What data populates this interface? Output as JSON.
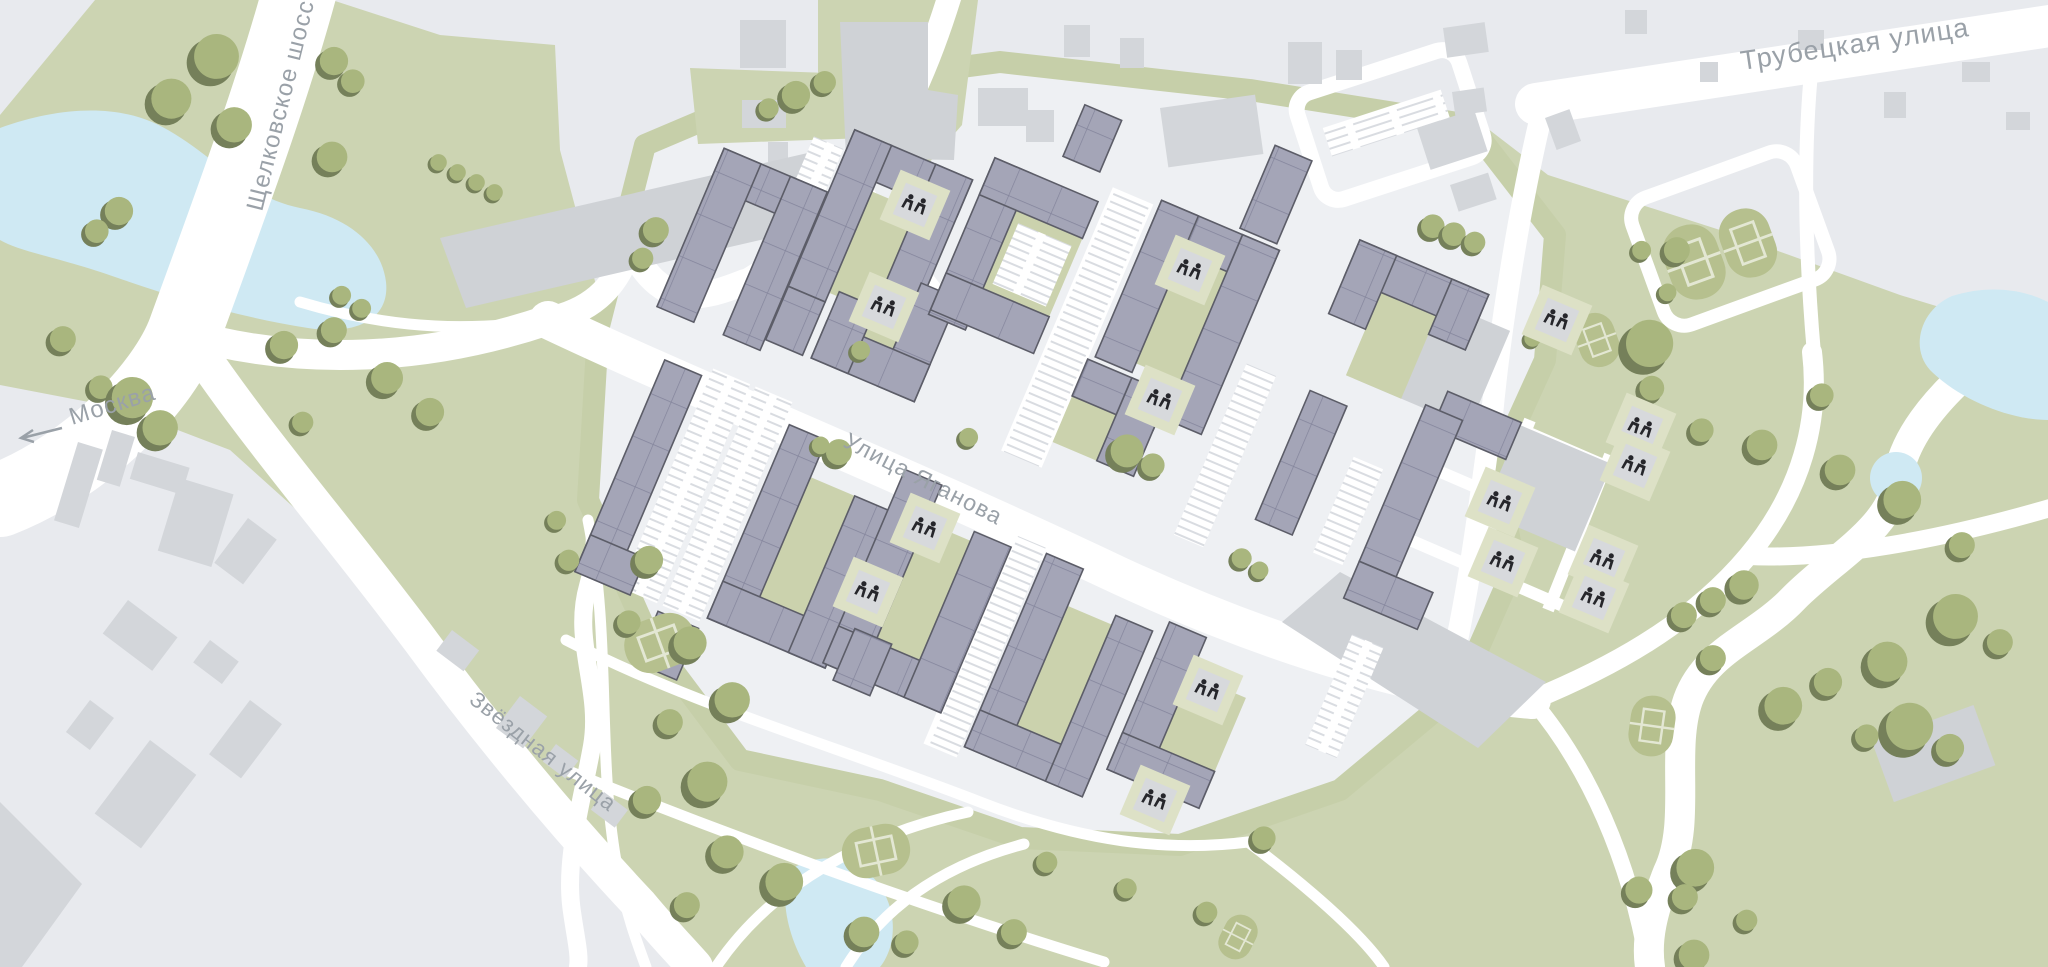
{
  "map": {
    "street_labels": {
      "trubetskaya": "Трубецкая улица",
      "shchelkovskoe": "Щелковское шоссе",
      "moskva": "Москва",
      "zvezdnaya": "Звёздная улица",
      "yaganova": "Улица Яганова"
    },
    "icons": {
      "tree": "round-canopy-with-shadow",
      "playground": "children-figures-on-pad",
      "sports_court": "stadium-field-with-markings",
      "moskva_arrow": "left-arrow"
    },
    "colors": {
      "parkland": "#ccd4b2",
      "urban": "#e8eaee",
      "complex_ground": "#eef0f3",
      "water": "#cfe9f3",
      "residential_building": "#a4a5b7",
      "building_outline": "#5c5d68",
      "context_building": "#d3d6da",
      "road": "#ffffff",
      "tree": "#a9b67e",
      "court": "#b6c08e",
      "label": "#9aa1a8"
    }
  }
}
